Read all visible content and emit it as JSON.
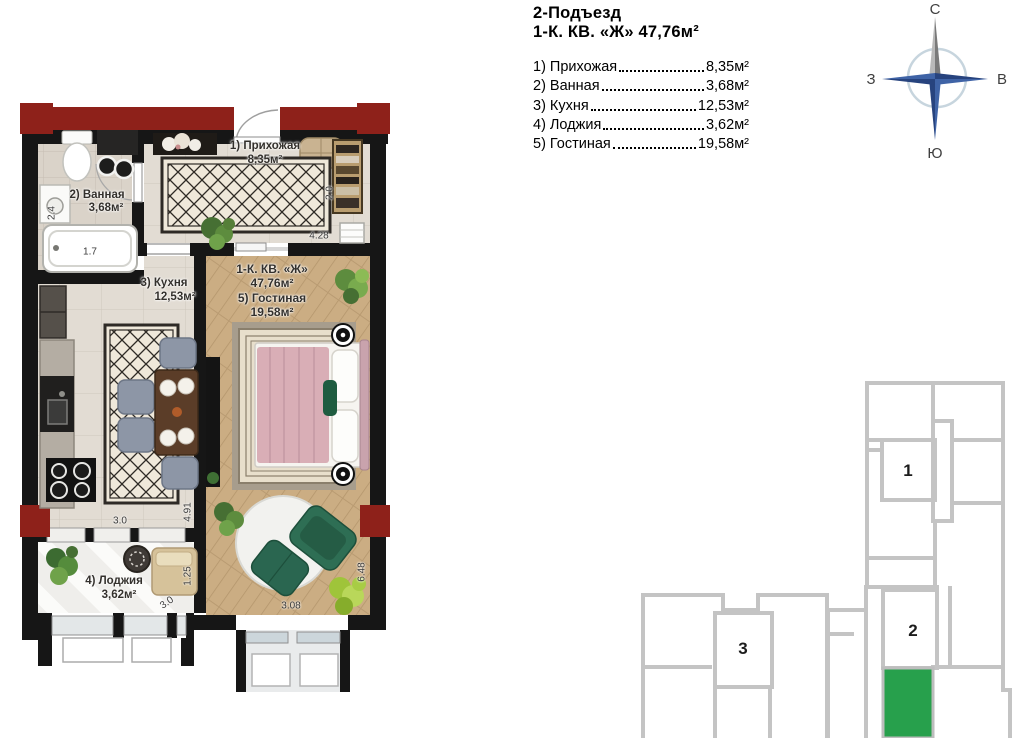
{
  "legend": {
    "title_line1": "2-Подъезд",
    "title_line2": "1-К. КВ. «Ж» 47,76м²",
    "rooms": [
      {
        "name": "1) Прихожая",
        "area": "8,35м²"
      },
      {
        "name": "2) Ванная",
        "area": "3,68м²"
      },
      {
        "name": "3) Кухня",
        "area": "12,53м²"
      },
      {
        "name": "4) Лоджия",
        "area": "3,62м²"
      },
      {
        "name": "5) Гостиная",
        "area": "19,58м²"
      }
    ]
  },
  "compass": {
    "north": "С",
    "south": "Ю",
    "west": "З",
    "east": "В"
  },
  "plan": {
    "hallway": {
      "name": "1) Прихожая",
      "area": "8,35м²"
    },
    "bathroom": {
      "name": "2) Ванная",
      "area": "3,68м²"
    },
    "kitchen": {
      "name": "3) Кухня",
      "area": "12,53м²"
    },
    "loggia": {
      "name": "4) Лоджия",
      "area": "3,62м²"
    },
    "living": {
      "line1": "1-К. КВ. «Ж»",
      "line2": "47,76м²",
      "line3": "5) Гостиная",
      "line4": "19,58м²"
    },
    "dims": {
      "d24": "2.4",
      "d17": "1.7",
      "d20": "2.0",
      "d428": "4.28",
      "d30k": "3.0",
      "d491": "4.91",
      "d125": "1.25",
      "d30l": "3.0",
      "d308": "3.08",
      "d648": "6.48"
    }
  },
  "keyplan": {
    "section1": "1",
    "section2": "2",
    "section3": "3",
    "highlight_color": "#27a04c"
  },
  "colors": {
    "wall_black": "#161616",
    "structure_red": "#8e211a",
    "keyplan_wall_gray": "#c4c4c4",
    "compass_blue_dark": "#27437e",
    "compass_blue_light": "#3f63a6",
    "compass_gray": "#9a9a9a",
    "wood_floor": "#cbad83",
    "bed_pink": "#d9aeb6",
    "armchair_green": "#2e6e54"
  }
}
